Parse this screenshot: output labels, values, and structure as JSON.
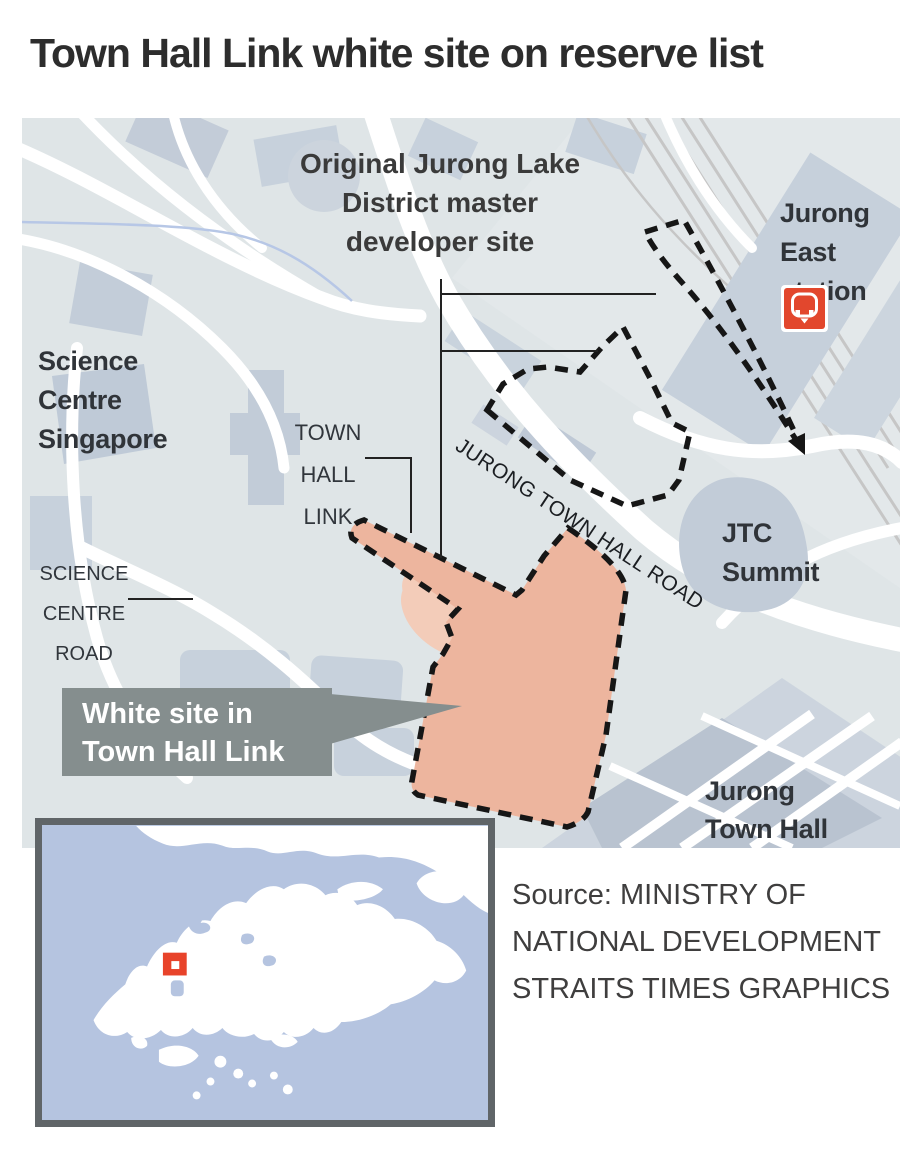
{
  "title": "Town Hall Link white site on reserve list",
  "map": {
    "labels": {
      "master_site": [
        "Original Jurong Lake",
        "District master",
        "developer site"
      ],
      "jurong_east": [
        "Jurong",
        "East",
        "station"
      ],
      "science_centre": [
        "Science",
        "Centre",
        "Singapore"
      ],
      "town_hall_link": [
        "TOWN",
        "HALL",
        "LINK"
      ],
      "road": "JURONG TOWN HALL ROAD",
      "jtc_summit": [
        "JTC",
        "Summit"
      ],
      "science_centre_road": [
        "SCIENCE",
        "CENTRE",
        "ROAD"
      ],
      "jurong_town_hall": [
        "Jurong",
        "Town Hall"
      ]
    },
    "callout": {
      "lines": [
        "White site in",
        "Town Hall Link"
      ]
    },
    "icons": {
      "mrt": "train-station-icon",
      "marker": "jurong-location-marker"
    }
  },
  "source": {
    "lines": [
      "Source: MINISTRY OF",
      "NATIONAL DEVELOPMENT",
      "STRAITS TIMES GRAPHICS"
    ]
  },
  "colors": {
    "title_color": "#2d2d2d",
    "map_bg": "#dfe5e7",
    "building": "#c7d1dc",
    "building_dark": "#b9c3d0",
    "road": "#ffffff",
    "rail": "#c6c6c6",
    "canal": "#b7c7e6",
    "site_fill": "#edb59e",
    "site_fill_light": "#f3ccb9",
    "dash_outline": "#161616",
    "callout_bg": "#858e8e",
    "mrt_red": "#e2472d",
    "marker_red": "#e8432a",
    "inset_water": "#b5c4e0",
    "inset_land": "#ffffff",
    "inset_border": "#606568"
  }
}
